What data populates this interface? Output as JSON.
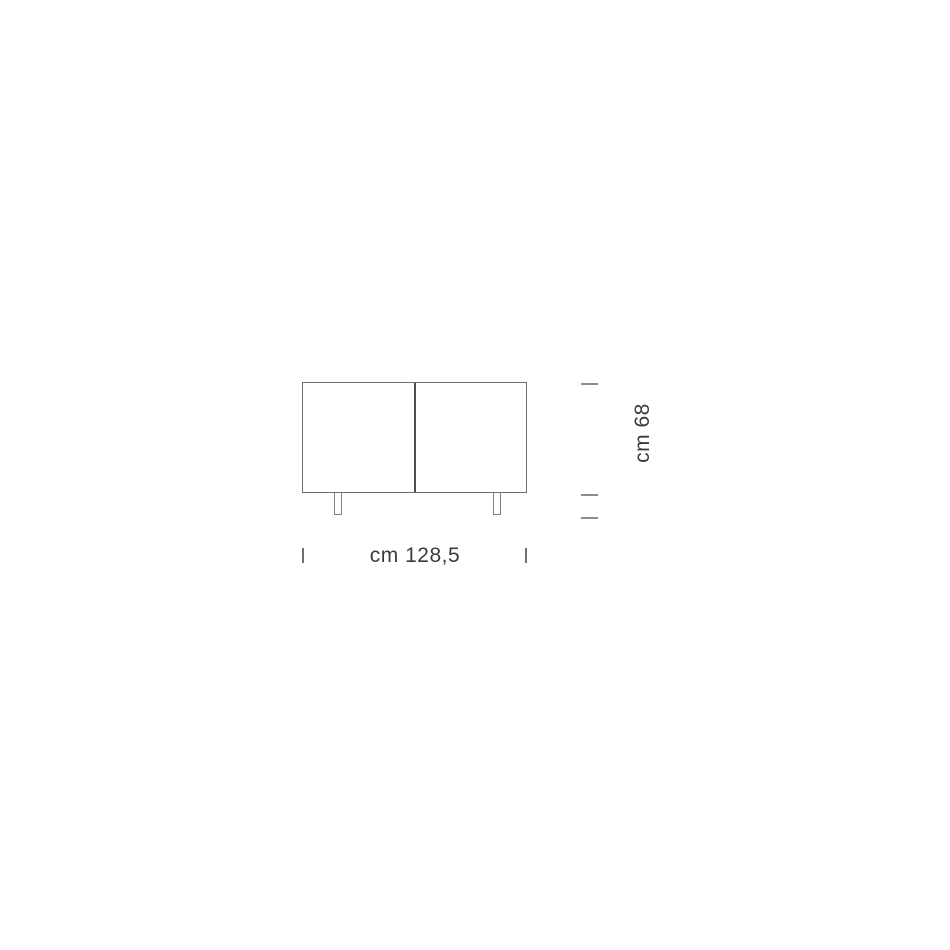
{
  "diagram": {
    "kind": "furniture-dimension-diagram",
    "subject": "two-door sideboard, front elevation",
    "door_panels": 2,
    "legs": 2,
    "dimensions": {
      "width": {
        "label": "cm 128,5",
        "value_cm": 128.5,
        "orientation": "horizontal"
      },
      "height": {
        "label": "cm 68",
        "value_cm": 68,
        "orientation": "vertical"
      }
    }
  },
  "colors": {
    "background": "#ffffff",
    "cabinet_outline": "#6f6f6f",
    "door_divider": "#4d4d4d",
    "leg_outline": "#808080",
    "tick_mark": "#8c8c8c",
    "label_text": "#3c3c3c"
  }
}
